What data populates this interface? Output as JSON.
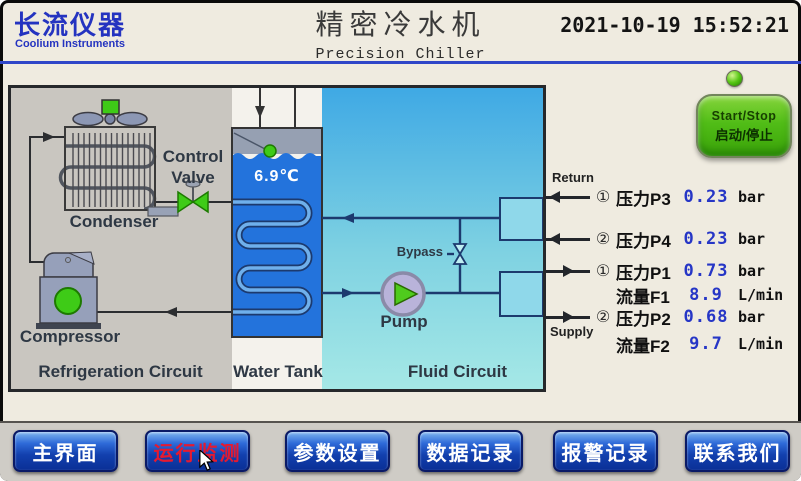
{
  "header": {
    "logo_cn": "长流仪器",
    "logo_en": "Coolium Instruments",
    "title_cn": "精密冷水机",
    "title_en": "Precision Chiller",
    "datetime": "2021-10-19 15:52:21"
  },
  "diagram": {
    "section_labels": {
      "refrigeration": "Refrigeration Circuit",
      "water_tank": "Water Tank",
      "fluid": "Fluid Circuit"
    },
    "component_labels": {
      "condenser": "Condenser",
      "compressor": "Compressor",
      "control_valve": "Control Valve",
      "pump": "Pump",
      "bypass": "Bypass"
    },
    "tank_temperature": "6.9℃"
  },
  "flow": {
    "return_label": "Return",
    "supply_label": "Supply"
  },
  "readings": [
    {
      "circle": "①",
      "label": "压力P3",
      "value": "0.23",
      "unit": "bar",
      "arrow": "left"
    },
    {
      "circle": "②",
      "label": "压力P4",
      "value": "0.23",
      "unit": "bar",
      "arrow": "left"
    },
    {
      "circle": "①",
      "label": "压力P1",
      "value": "0.73",
      "unit": "bar",
      "arrow": "right"
    },
    {
      "circle": "",
      "label": "流量F1",
      "value": "8.9",
      "unit": "L/min",
      "arrow": "none"
    },
    {
      "circle": "②",
      "label": "压力P2",
      "value": "0.68",
      "unit": "bar",
      "arrow": "right"
    },
    {
      "circle": "",
      "label": "流量F2",
      "value": "9.7",
      "unit": "L/min",
      "arrow": "none"
    }
  ],
  "controls": {
    "start_stop_en": "Start/Stop",
    "start_stop_cn": "启动/停止"
  },
  "nav": {
    "items": [
      {
        "label": "主界面",
        "active": false
      },
      {
        "label": "运行监测",
        "active": true
      },
      {
        "label": "参数设置",
        "active": false
      },
      {
        "label": "数据记录",
        "active": false
      },
      {
        "label": "报警记录",
        "active": false
      },
      {
        "label": "联系我们",
        "active": false
      }
    ]
  },
  "colors": {
    "screen_bg": "#efebe0",
    "brand_blue": "#2433c0",
    "value_blue": "#2636c6",
    "active_red": "#e51a30",
    "indicator_green": "#3ecb17",
    "water_blue": "#2373dc",
    "fluid_cyan": "#5fc6e6",
    "nav_blue": "#0a2f96"
  }
}
